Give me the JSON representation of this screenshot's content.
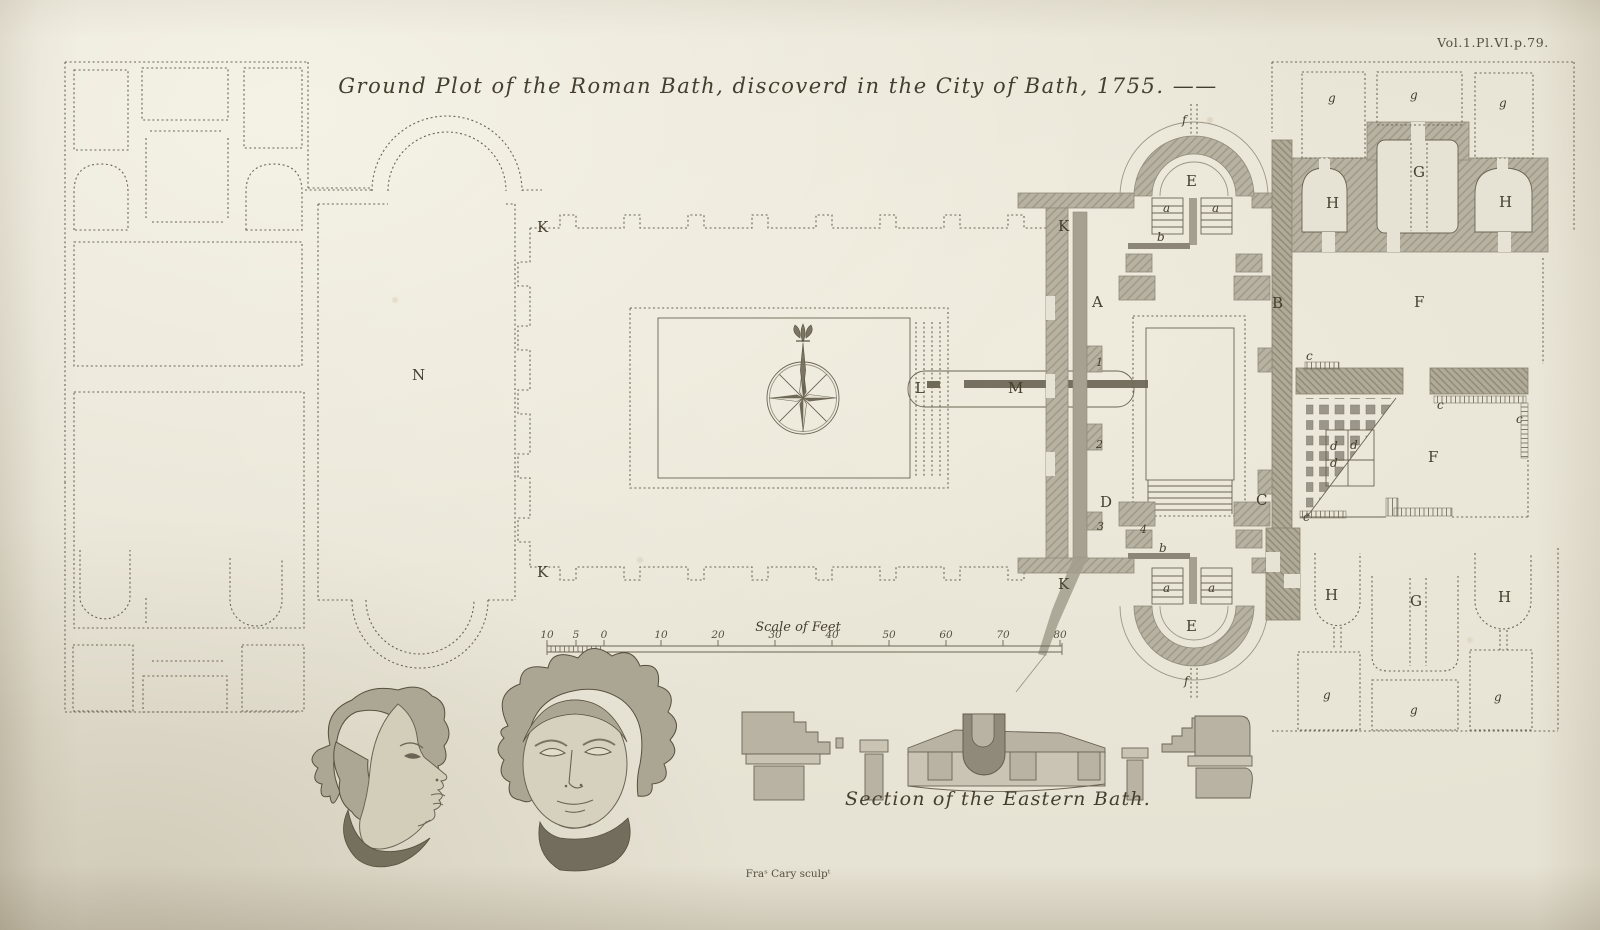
{
  "plate": {
    "volume_reference": "Vol.1.Pl.VI.p.79.",
    "title": "Ground Plot of the Roman Bath, discoverd in the City of Bath, 1755. ——",
    "section_caption": "Section of the Eastern Bath.",
    "engraver_credit": "Fraˢ Cary sculpᵗ"
  },
  "scale_bar": {
    "label": "Scale of Feet",
    "ticks": [
      "10",
      "5",
      "0",
      "10",
      "20",
      "30",
      "40",
      "50",
      "60",
      "70",
      "80"
    ]
  },
  "letters": {
    "K": "K",
    "N": "N",
    "A": "A",
    "B": "B",
    "C": "C",
    "D": "D",
    "E": "E",
    "F": "F",
    "G": "G",
    "H": "H",
    "L": "L",
    "M": "M",
    "a": "a",
    "b": "b",
    "c": "c",
    "d": "d",
    "f": "f",
    "g": "g",
    "n1": "1",
    "n2": "2",
    "n3": "3",
    "n4": "4"
  }
}
